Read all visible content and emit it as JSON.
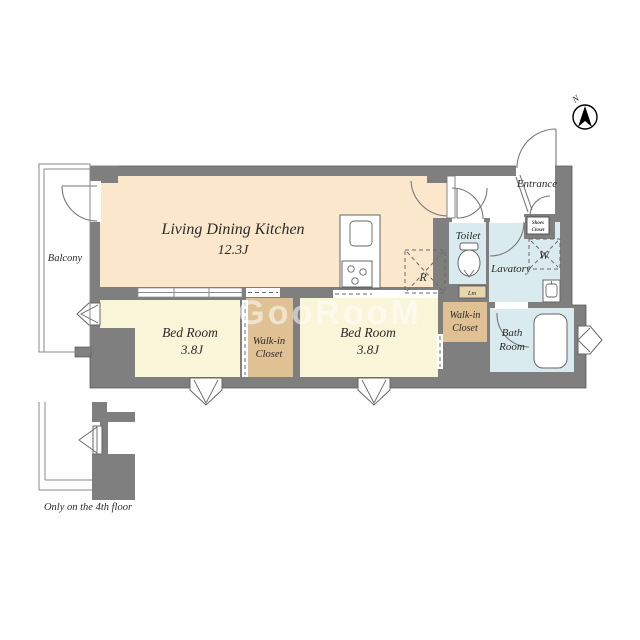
{
  "plan": {
    "watermark": "GooRooM",
    "compass": {
      "north_label": "N"
    },
    "note": {
      "only_floor": "Only on the 4th floor"
    },
    "colors": {
      "wall": "#7f7f7f",
      "ldk": "#fbe7cc",
      "bedroom": "#f9f5d8",
      "closet": "#dfc193",
      "wet": "#d9ebee",
      "linen": "#e7d6ac"
    },
    "rooms": {
      "ldk": {
        "name": "Living Dining Kitchen",
        "size": "12.3J"
      },
      "bedroom1": {
        "name": "Bed Room",
        "size": "3.8J"
      },
      "bedroom2": {
        "name": "Bed Room",
        "size": "3.8J"
      },
      "wic1": {
        "line1": "Walk-in",
        "line2": "Closet"
      },
      "wic2": {
        "line1": "Walk-in",
        "line2": "Closet"
      },
      "toilet": {
        "name": "Toilet"
      },
      "lavatory": {
        "name": "Lavatory"
      },
      "bath": {
        "line1": "Bath",
        "line2": "Room"
      },
      "entrance": {
        "name": "Entrance"
      },
      "balcony": {
        "name": "Balcony"
      },
      "shoes_closet": {
        "line1": "Shoes",
        "line2": "Closet"
      },
      "linen": {
        "abbr": "Lm"
      }
    },
    "fixtures": {
      "refrigerator_abbr": "R",
      "washer_abbr": "W"
    }
  }
}
